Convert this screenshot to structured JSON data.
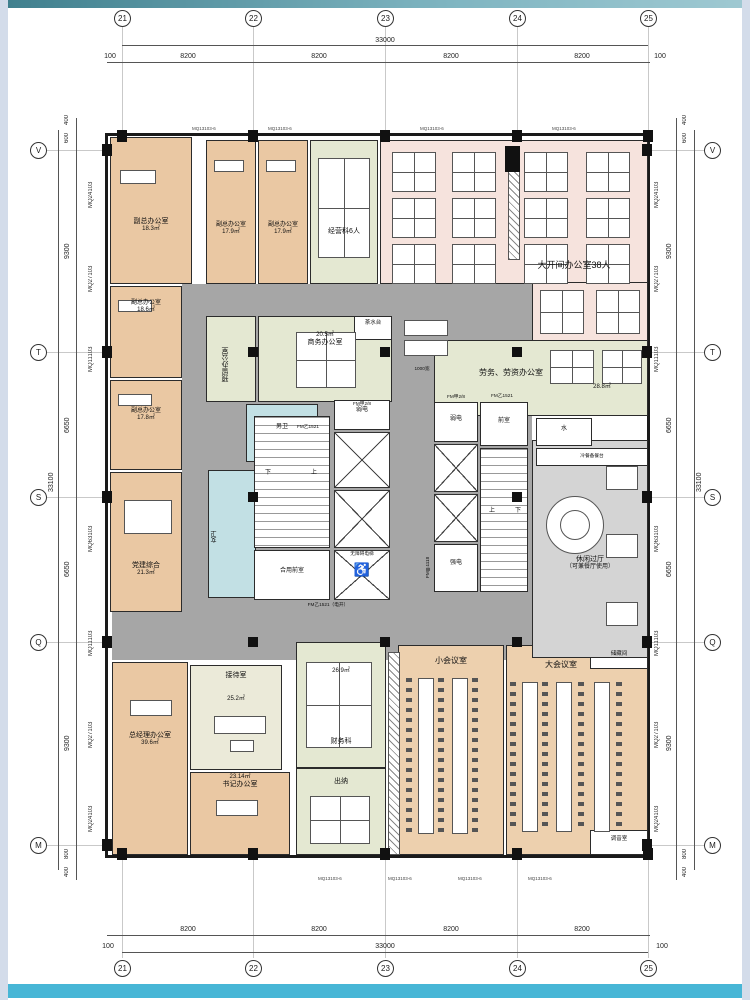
{
  "grid": {
    "cols": [
      "21",
      "22",
      "23",
      "24",
      "25"
    ],
    "rows": [
      "V",
      "T",
      "S",
      "Q",
      "M"
    ]
  },
  "dims": {
    "h_total": "33000",
    "h_seg": "8200",
    "h_edge": "100",
    "v_total": "33100",
    "v_segs": [
      "9300",
      "6650",
      "6650",
      "9300"
    ],
    "v_top": [
      "400",
      "600"
    ],
    "v_bottom": [
      "800",
      "400"
    ]
  },
  "wall_codes": {
    "side": [
      "MQ24103",
      "MQ27103",
      "MQ11103",
      "MQ63103",
      "MQ11103",
      "MQ27103",
      "MQ24103"
    ],
    "top_code": "MQ13103-6"
  },
  "rooms": {
    "vice_a": {
      "name": "副总办公室",
      "area": "18.3㎡"
    },
    "vice_b": {
      "name": "副总办公室",
      "area": "17.9㎡"
    },
    "vice_c": {
      "name": "副总办公室",
      "area": "17.9㎡"
    },
    "jingying": {
      "name": "经营科6人"
    },
    "open_office": {
      "name": "大开间办公室38人"
    },
    "vice_d": {
      "name": "副总办公室",
      "area": "18.6㎡"
    },
    "vice_e": {
      "name": "副总办公室",
      "area": "17.8㎡"
    },
    "dangjian": {
      "name": "党建综合",
      "area": "21.3㎡"
    },
    "gm": {
      "name": "总经理办公室",
      "area": "39.6㎡"
    },
    "reception": {
      "name": "接待室",
      "area": "25.2㎡"
    },
    "secretary": {
      "name": "书记办公室",
      "area": "23.14㎡"
    },
    "cashier": {
      "name": "出纳"
    },
    "finance": {
      "name": "财务科",
      "area": "26.9㎡"
    },
    "small_meeting": {
      "name": "小会议室"
    },
    "large_meeting": {
      "name": "大会议室"
    },
    "storage": {
      "name": "储藏间"
    },
    "sound": {
      "name": "调音室"
    },
    "labor": {
      "name": "劳务、劳资办公室",
      "area": "28.8㎡"
    },
    "business": {
      "name": "商务办公室",
      "area": "20.5㎡"
    },
    "reserved": {
      "name": "预留办公室"
    },
    "lounge": {
      "name": "休闲过厅",
      "note": "（可兼餐厅使用）"
    },
    "toilet_m": {
      "name": "男卫"
    },
    "toilet_f": {
      "name": "女卫"
    },
    "tea": {
      "name": "茶水台"
    },
    "buffet": {
      "name": "冷餐备餐台"
    },
    "water": {
      "name": "水"
    }
  },
  "core": {
    "weak": "弱电",
    "strong": "强电",
    "ante": "前室",
    "shared_ante": "合用前室",
    "acc_elev": "无障碍电梯",
    "wheelchair": "♿",
    "fm_a28": "FM甲2/8",
    "fm_b1521": "FM乙1521",
    "fm_b1521_open": "FM乙1521（电开）",
    "fm_a1118": "FM甲1118",
    "w1000": "1000宽",
    "up": "上",
    "down": "下"
  }
}
